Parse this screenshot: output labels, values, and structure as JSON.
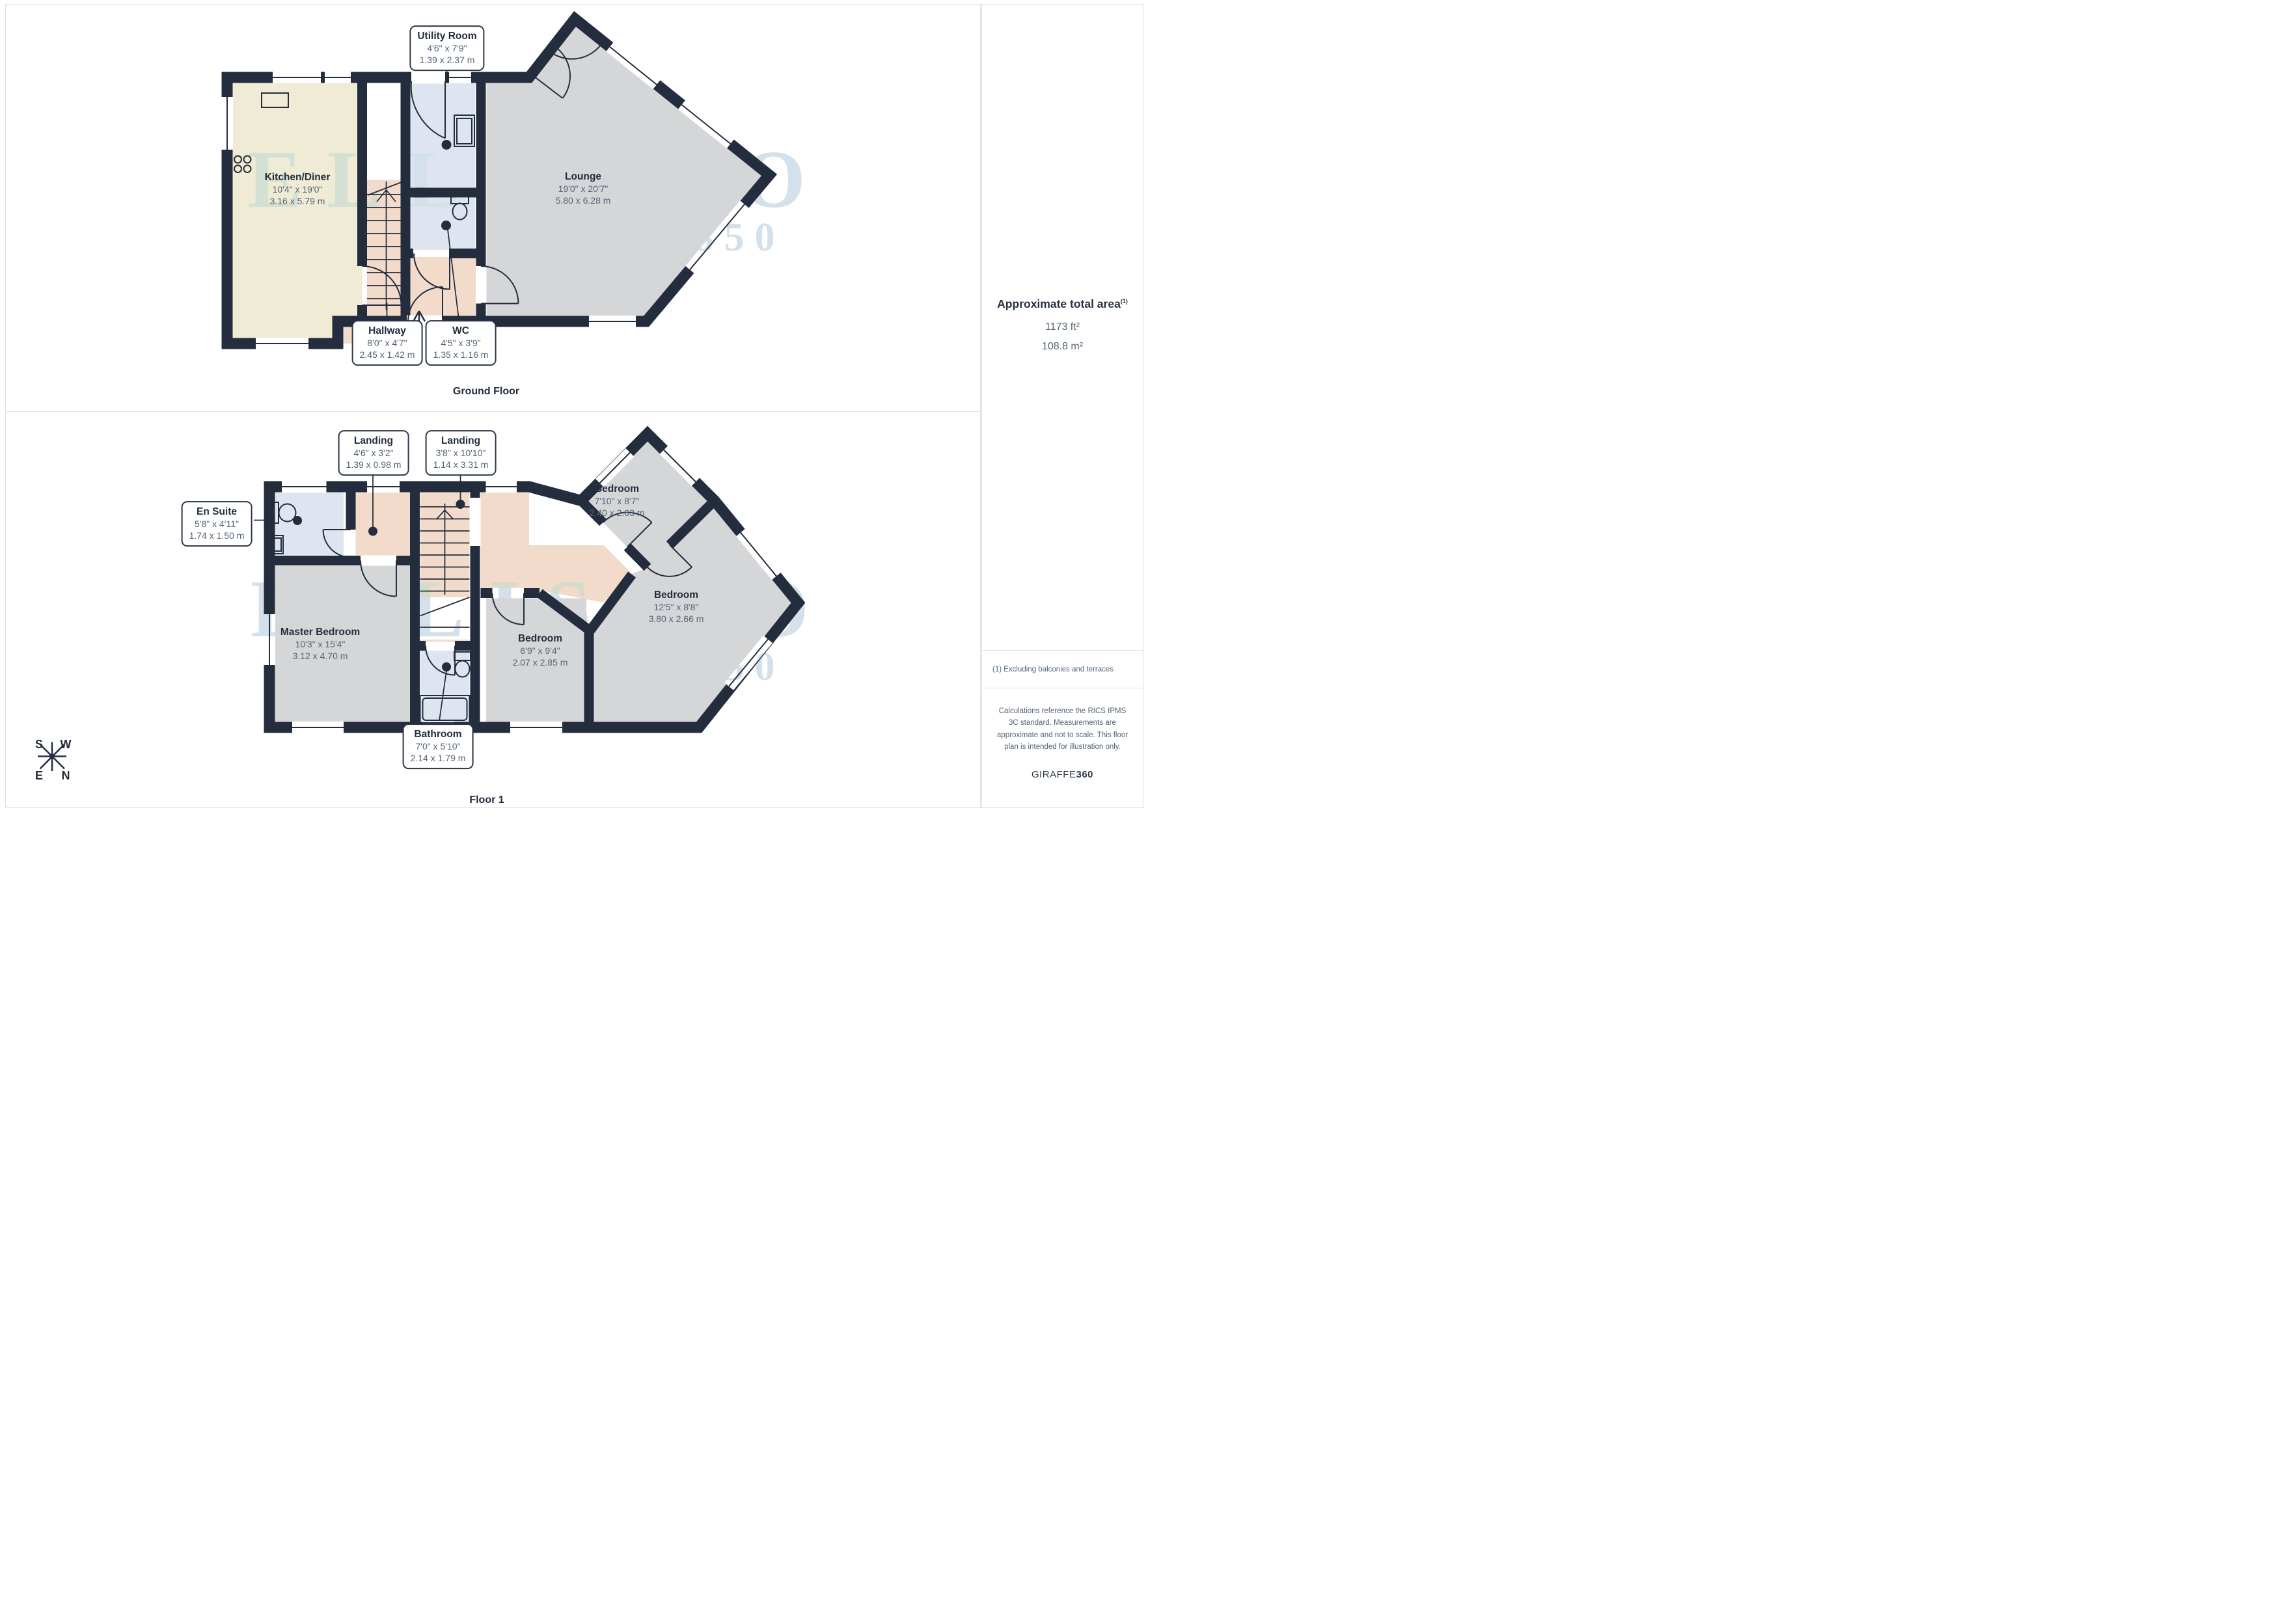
{
  "ground_floor": {
    "caption": "Ground Floor",
    "rooms": {
      "utility": {
        "name": "Utility Room",
        "imperial": "4'6\" x 7'9\"",
        "metric": "1.39 x 2.37 m"
      },
      "kitchen": {
        "name": "Kitchen/Diner",
        "imperial": "10'4\" x 19'0\"",
        "metric": "3.16 x 5.79 m"
      },
      "lounge": {
        "name": "Lounge",
        "imperial": "19'0\" x 20'7\"",
        "metric": "5.80 x 6.28 m"
      },
      "hallway": {
        "name": "Hallway",
        "imperial": "8'0\" x 4'7\"",
        "metric": "2.45 x 1.42 m"
      },
      "wc": {
        "name": "WC",
        "imperial": "4'5\" x 3'9\"",
        "metric": "1.35 x 1.16 m"
      }
    }
  },
  "floor1": {
    "caption": "Floor 1",
    "rooms": {
      "landing1": {
        "name": "Landing",
        "imperial": "4'6\" x 3'2\"",
        "metric": "1.39 x 0.98 m"
      },
      "landing2": {
        "name": "Landing",
        "imperial": "3'8\" x 10'10\"",
        "metric": "1.14 x 3.31 m"
      },
      "ensuite": {
        "name": "En Suite",
        "imperial": "5'8\" x 4'11\"",
        "metric": "1.74 x 1.50 m"
      },
      "master": {
        "name": "Master Bedroom",
        "imperial": "10'3\" x 15'4\"",
        "metric": "3.12 x 4.70 m"
      },
      "bedroom_ne": {
        "name": "Bedroom",
        "imperial": "7'10\" x 8'7\"",
        "metric": "2.40 x 2.63 m"
      },
      "bedroom_e": {
        "name": "Bedroom",
        "imperial": "12'5\" x 8'8\"",
        "metric": "3.80 x 2.66 m"
      },
      "bedroom_s": {
        "name": "Bedroom",
        "imperial": "6'9\" x 9'4\"",
        "metric": "2.07 x 2.85 m"
      },
      "bathroom": {
        "name": "Bathroom",
        "imperial": "7'0\" x 5'10\"",
        "metric": "2.14 x 1.79 m"
      }
    }
  },
  "sidebar": {
    "area_title": "Approximate total area",
    "area_sup": "(1)",
    "area_ft": "1173 ft²",
    "area_m": "108.8 m²",
    "footnote": "(1) Excluding balconies and terraces",
    "disclaimer": "Calculations reference the RICS IPMS 3C standard. Measurements are approximate and not to scale. This floor plan is intended for illustration only.",
    "brand_light": "GIRAFFE",
    "brand_bold": "360"
  },
  "compass": {
    "s": "S",
    "w": "W",
    "e": "E",
    "n": "N"
  },
  "watermark": {
    "line1": "ELLIS CO",
    "line2": "EST. 1850"
  },
  "colors": {
    "wall": "#232d3d",
    "kitchen_floor": "#f0ebd4",
    "living_floor": "#d5d6d7",
    "wet_floor": "#dfe5f0",
    "hall_floor": "#f3dbcb",
    "dim_text": "#54637a",
    "watermark": "#d4e0ea"
  }
}
